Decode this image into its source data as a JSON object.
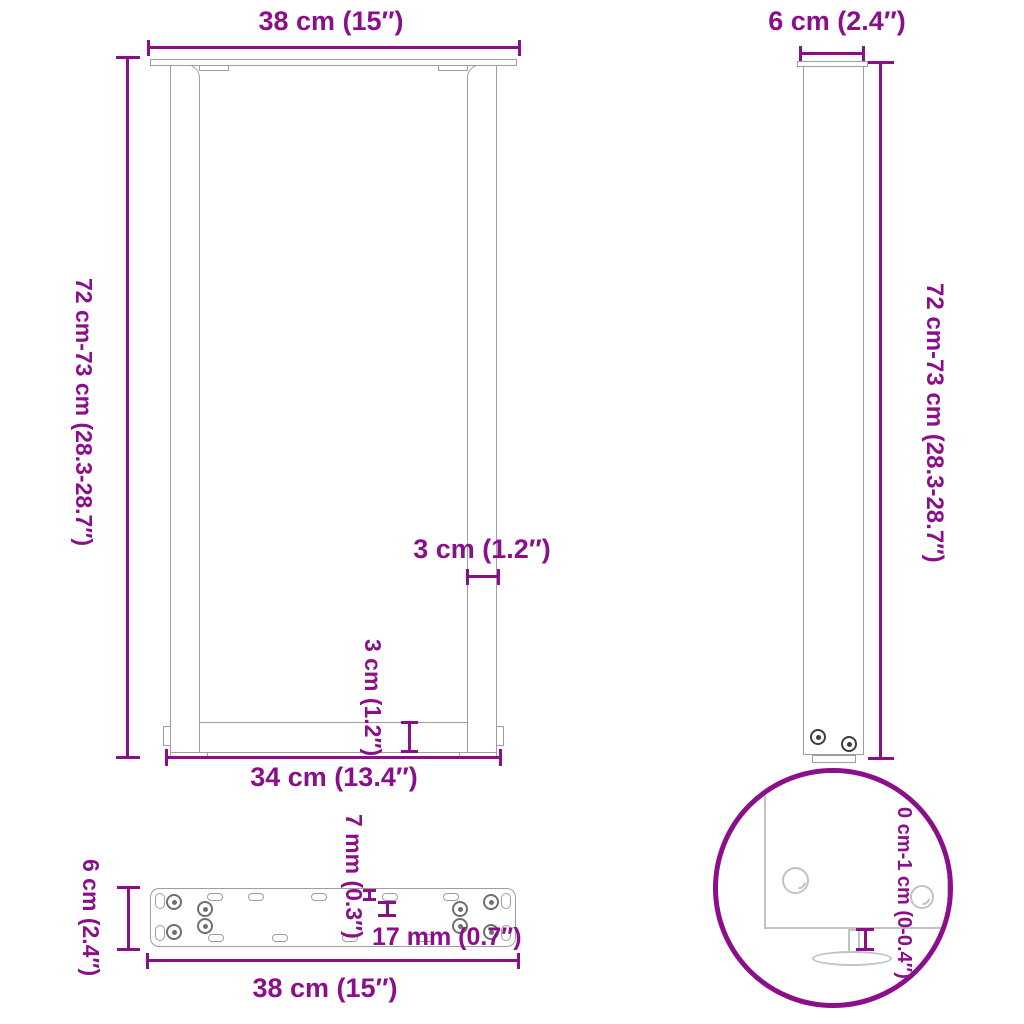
{
  "colors": {
    "accent": "#8B0E8B",
    "outline": "#9E9E9E",
    "outline_light": "#C2C2C2",
    "screw": "#3E3E3E",
    "hole": "#6F6F6F"
  },
  "front_view": {
    "width_label": "38 cm (15″)",
    "height_label": "72 cm-73 cm (28.3-28.7″)",
    "leg_thickness_label": "3 cm (1.2″)",
    "crossbar_thickness_label": "3 cm (1.2″)",
    "inner_width_label": "34 cm (13.4″)"
  },
  "side_view": {
    "depth_label": "6 cm (2.4″)",
    "height_label": "72 cm-73 cm (28.3-28.7″)"
  },
  "plate_view": {
    "depth_label": "6 cm (2.4″)",
    "slot_width_label": "7 mm (0.3″)",
    "slot_length_label": "17 mm (0.7″)",
    "width_label": "38 cm (15″)"
  },
  "detail_view": {
    "adjustable_height_label": "0 cm-1 cm (0-0.4″)"
  }
}
